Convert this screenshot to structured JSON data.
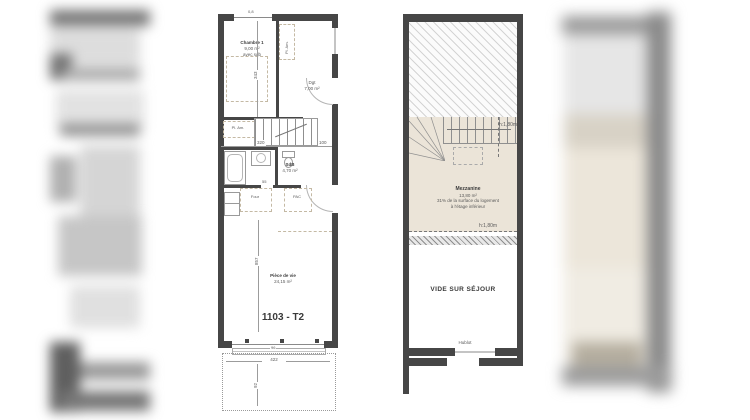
{
  "title": "1103 - T2",
  "left": {
    "chambre": {
      "name": "Chambre 1",
      "area": "9,00 m²",
      "note": "avec sdb"
    },
    "dgt": {
      "name": "Dgt",
      "area": "7,00 m²"
    },
    "sdb": {
      "name": "SdB",
      "area": "4,70 m²"
    },
    "piece": {
      "name": "Pièce de vie",
      "area": "24,15 m²"
    },
    "closet_top": "Pl. Am.",
    "closet_entry": "Pl. Am.",
    "four": "Four",
    "pac": "PAC",
    "dims": {
      "d08": "0,8",
      "d343": "343",
      "d320": "320",
      "d100": "100",
      "d55": "55",
      "d857": "857",
      "d96": "96",
      "d422": "422",
      "d92": "92"
    }
  },
  "right": {
    "mezz": {
      "name": "Mezzanine",
      "area": "13,80 m²",
      "note1": "31% de la surface du logement",
      "note2": "à l'étage inférieur"
    },
    "vide": "VIDE SUR SÉJOUR",
    "hublot": "Hublot",
    "h_top": "h:1,80m",
    "h_bottom": "h:1,80m"
  },
  "colors": {
    "wall": "#464646",
    "beige": "#ebe4d8",
    "hatch": "#cfcfcf",
    "dashed": "#c4b9a4",
    "dim": "#9c9c9c",
    "text": "#4a4a4a"
  }
}
